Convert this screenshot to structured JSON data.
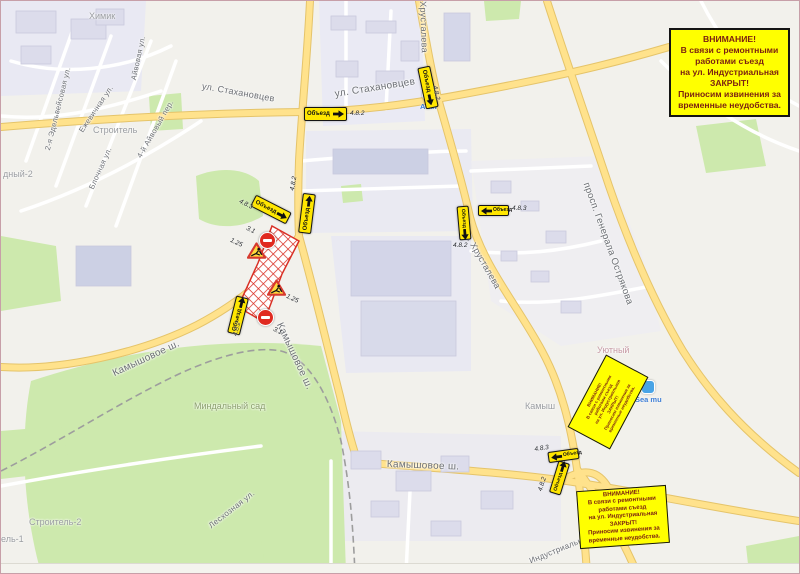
{
  "map": {
    "attention_box": {
      "lines": [
        "ВНИМАНИЕ!",
        "В связи с ремонтными",
        "работами съезд",
        "на ул. Индустриальная",
        "ЗАКРЫТ!",
        "Приносим извинения за",
        "временные неудобства."
      ]
    },
    "detour_label": "Объезд",
    "pois": {
      "atan": {
        "name": "Atan"
      },
      "sea_mall": {
        "name": "Sea mu"
      }
    },
    "street_labels": [
      {
        "t": "ул. Стахановцев",
        "x": 202,
        "y": 80,
        "r": 10,
        "s": 9
      },
      {
        "t": "ул. Стахановцев",
        "x": 333,
        "y": 88,
        "r": -9,
        "s": 10
      },
      {
        "t": "Хрусталева",
        "x": 427,
        "y": 0,
        "r": 88,
        "s": 9
      },
      {
        "t": "ул. Хрусталева",
        "x": 468,
        "y": 226,
        "r": 60,
        "s": 9
      },
      {
        "t": "просп. Генерала Острякова",
        "x": 590,
        "y": 180,
        "r": 70,
        "s": 9.5
      },
      {
        "t": "Камышовое ш.",
        "x": 110,
        "y": 368,
        "r": -25,
        "s": 10
      },
      {
        "t": "Камышовое ш.",
        "x": 283,
        "y": 320,
        "r": 65,
        "s": 10
      },
      {
        "t": "Камышовое ш.",
        "x": 386,
        "y": 458,
        "r": 2,
        "s": 10
      },
      {
        "t": "Лесхозная ул.",
        "x": 206,
        "y": 522,
        "r": -38,
        "s": 8
      },
      {
        "t": "2-я Эдельвейсовая ул.",
        "x": 42,
        "y": 148,
        "r": -76,
        "s": 7.5
      },
      {
        "t": "Ежевичная ул.",
        "x": 76,
        "y": 128,
        "r": -56,
        "s": 7.5
      },
      {
        "t": "Айвовая ул.",
        "x": 128,
        "y": 78,
        "r": -78,
        "s": 7.5
      },
      {
        "t": "4-й Айвовый пер.",
        "x": 134,
        "y": 154,
        "r": -60,
        "s": 7.5
      },
      {
        "t": "Блочная ул.",
        "x": 86,
        "y": 186,
        "r": -66,
        "s": 7.5
      },
      {
        "t": "Индустриальная ул.",
        "x": 527,
        "y": 556,
        "r": -22,
        "s": 8
      }
    ],
    "area_labels": [
      {
        "t": "Химик",
        "x": 88,
        "y": 10,
        "s": 9,
        "c": ""
      },
      {
        "t": "Строитель",
        "x": 92,
        "y": 124,
        "s": 9,
        "c": ""
      },
      {
        "t": "дный-2",
        "x": 2,
        "y": 168,
        "s": 9,
        "c": ""
      },
      {
        "t": "Миндальный сад",
        "x": 193,
        "y": 400,
        "s": 9,
        "c": "green"
      },
      {
        "t": "Камыш",
        "x": 524,
        "y": 400,
        "s": 9,
        "c": ""
      },
      {
        "t": "Уютный",
        "x": 596,
        "y": 344,
        "s": 9,
        "c": "pink"
      },
      {
        "t": "Строитель-2",
        "x": 28,
        "y": 516,
        "s": 9,
        "c": ""
      },
      {
        "t": "ель-1",
        "x": 0,
        "y": 533,
        "s": 9,
        "c": ""
      }
    ],
    "detour_signs": [
      {
        "x": 303,
        "y": 106,
        "w": 43,
        "h": 14,
        "r": 0,
        "arrow": "right"
      },
      {
        "x": 406,
        "y": 80,
        "w": 42,
        "h": 13,
        "r": 78,
        "arrow": "right"
      },
      {
        "x": 250,
        "y": 202,
        "w": 40,
        "h": 13,
        "r": 27,
        "arrow": "right"
      },
      {
        "x": 286,
        "y": 206,
        "w": 40,
        "h": 13,
        "r": -83,
        "arrow": "right"
      },
      {
        "x": 218,
        "y": 308,
        "w": 38,
        "h": 13,
        "r": -76,
        "arrow": "right"
      },
      {
        "x": 477,
        "y": 204,
        "w": 31,
        "h": 11,
        "r": 0,
        "arrow": "left"
      },
      {
        "x": 446,
        "y": 216,
        "w": 34,
        "h": 12,
        "r": 85,
        "arrow": "right"
      },
      {
        "x": 547,
        "y": 449,
        "w": 31,
        "h": 11,
        "r": -8,
        "arrow": "left"
      },
      {
        "x": 542,
        "y": 471,
        "w": 33,
        "h": 12,
        "r": -73,
        "arrow": "right"
      }
    ],
    "sign_codes": [
      {
        "t": "4.8.2",
        "x": 349,
        "y": 109,
        "r": 0
      },
      {
        "t": "4.8.2",
        "x": 437,
        "y": 84,
        "r": 78
      },
      {
        "t": "4.8.3",
        "x": 240,
        "y": 197,
        "r": 27
      },
      {
        "t": "4.8.2",
        "x": 288,
        "y": 189,
        "r": -80
      },
      {
        "t": "4.8.2",
        "x": 231,
        "y": 334,
        "r": -76
      },
      {
        "t": "4.8.3",
        "x": 511,
        "y": 204,
        "r": 0
      },
      {
        "t": "4.8.2",
        "x": 452,
        "y": 241,
        "r": 0
      },
      {
        "t": "4.8.3",
        "x": 533,
        "y": 445,
        "r": -8
      },
      {
        "t": "4.8.2",
        "x": 536,
        "y": 489,
        "r": -73
      },
      {
        "t": "4.8.2",
        "x": 623,
        "y": 401,
        "r": -62
      },
      {
        "t": "3.1",
        "x": 247,
        "y": 224,
        "r": 25
      },
      {
        "t": "3.1",
        "x": 274,
        "y": 325,
        "r": 25
      },
      {
        "t": "1.25",
        "x": 231,
        "y": 236,
        "r": 25
      },
      {
        "t": "1.25",
        "x": 287,
        "y": 292,
        "r": 25
      }
    ],
    "no_entry_signs": [
      {
        "x": 258,
        "y": 231,
        "d": 17
      },
      {
        "x": 256,
        "y": 308,
        "d": 17
      }
    ],
    "roadworks_signs": [
      {
        "x": 246,
        "y": 241,
        "s": 19
      },
      {
        "x": 266,
        "y": 278,
        "s": 19
      }
    ],
    "colors": {
      "notice_bg": "#ffff00",
      "notice_text": "#7a1f12",
      "sign_yellow": "#ffe600",
      "closure_red": "#d93025",
      "road_yellow": "#ffe28c",
      "park_green": "#cde9ad"
    }
  }
}
